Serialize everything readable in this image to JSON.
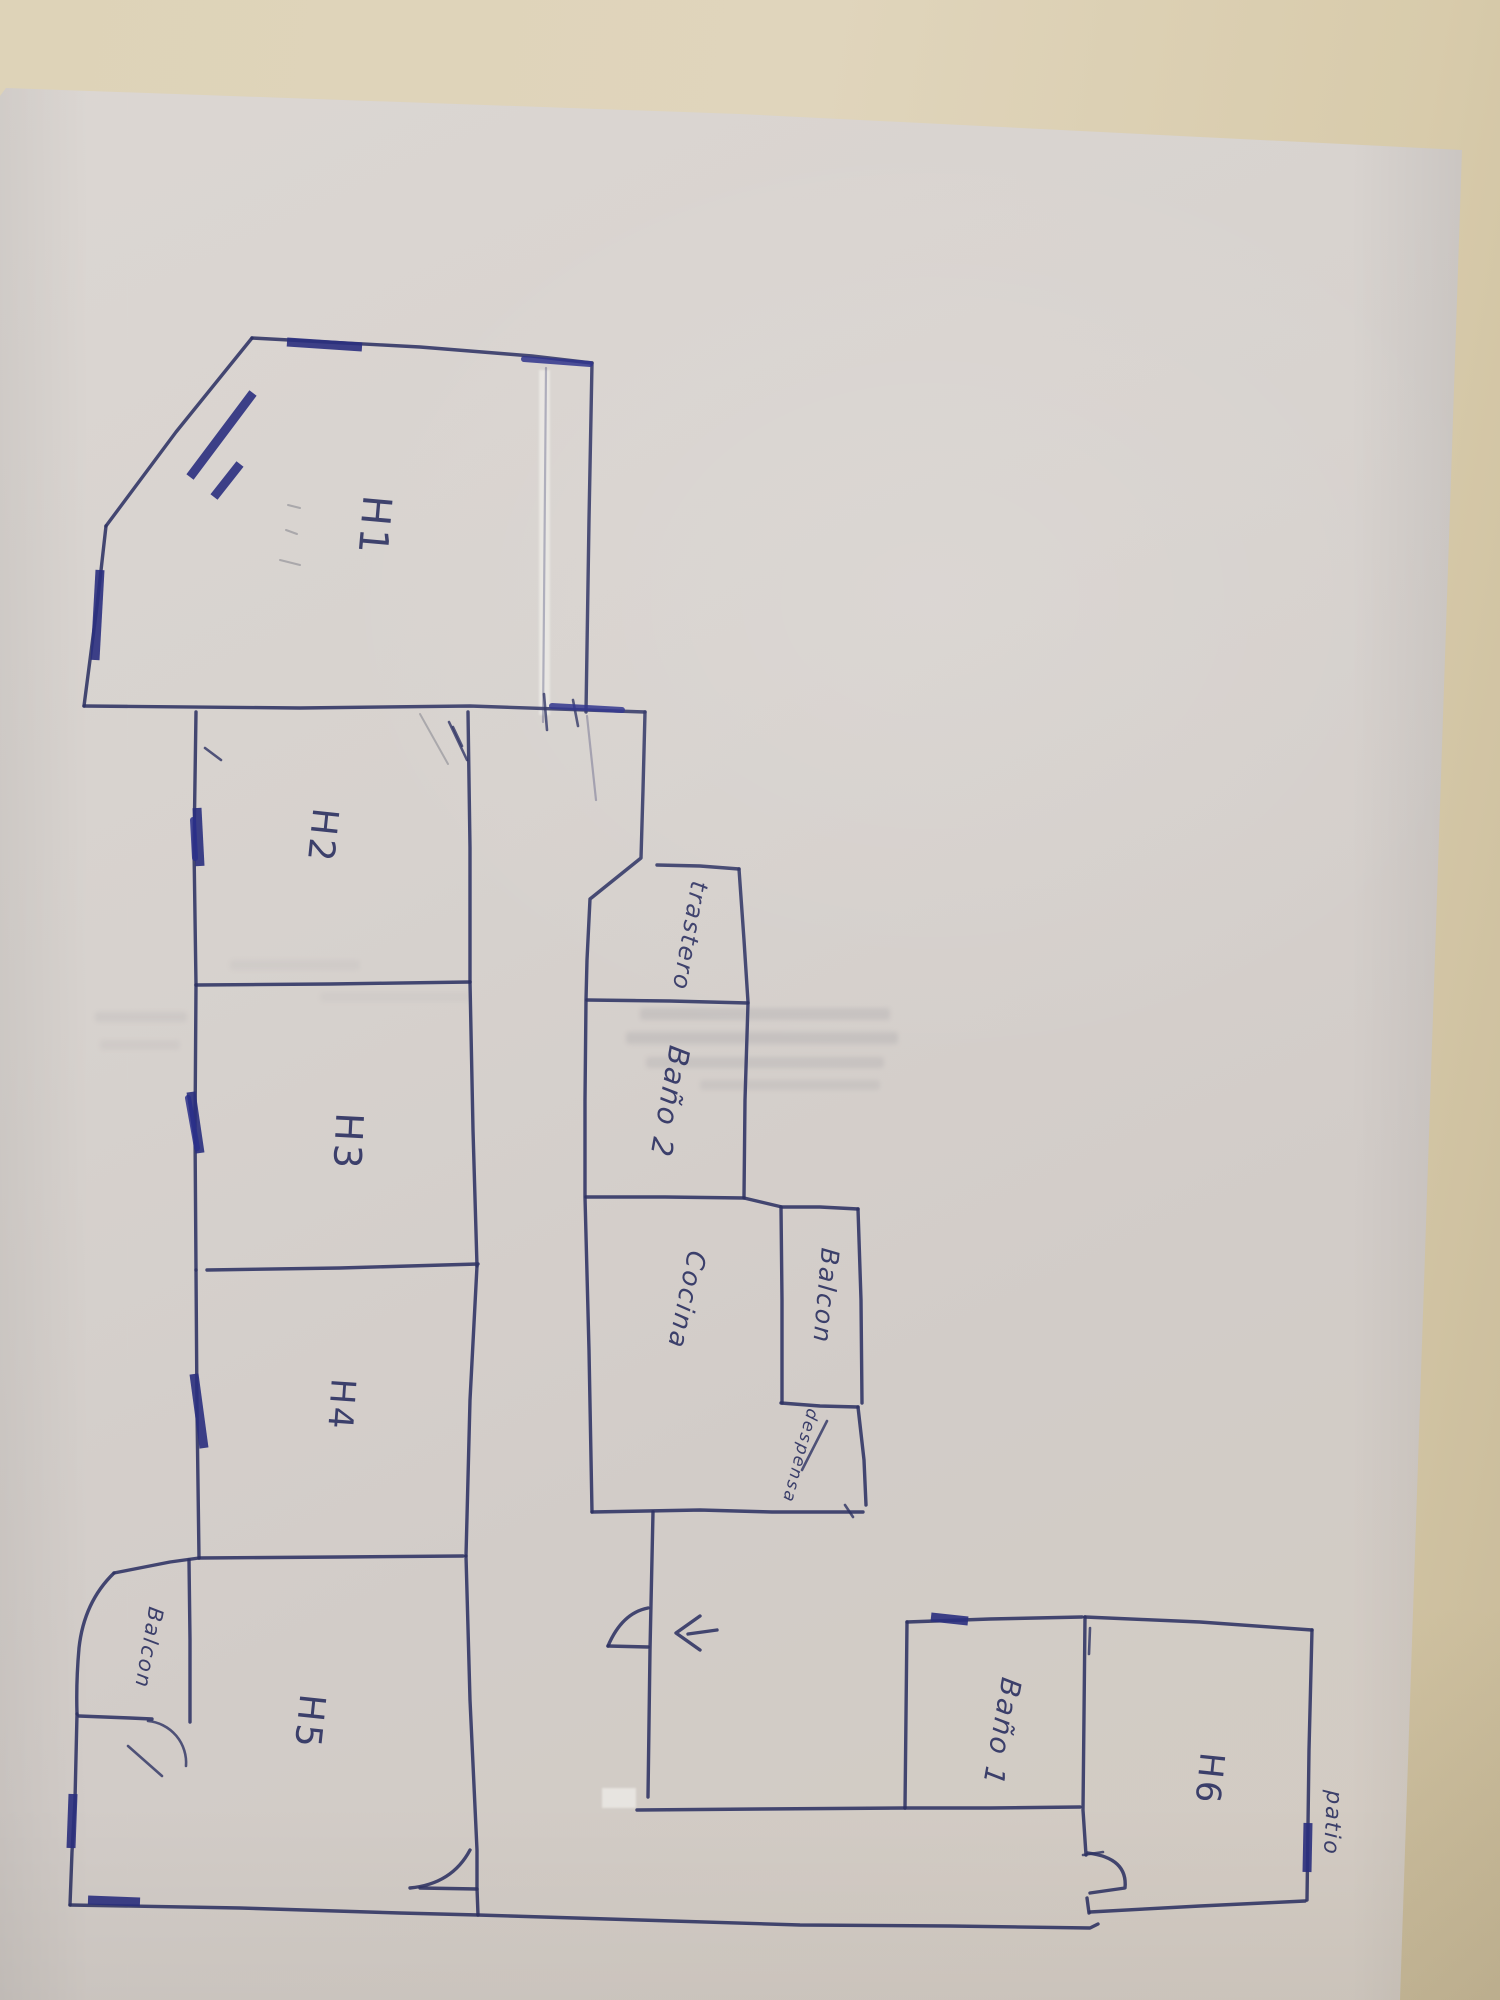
{
  "scene": {
    "description": "Hand-drawn apartment floor plan in blue ballpoint pen on a white sheet, photographed sideways on a beige table; all room labels are written rotated 90 degrees"
  },
  "floor_plan": {
    "rooms": [
      {
        "id": "h1",
        "label": "H1"
      },
      {
        "id": "h2",
        "label": "H2"
      },
      {
        "id": "h3",
        "label": "H3"
      },
      {
        "id": "h4",
        "label": "H4"
      },
      {
        "id": "h5",
        "label": "H5"
      },
      {
        "id": "balcon-left",
        "label": "Balcon"
      },
      {
        "id": "trastero",
        "label": "trastero"
      },
      {
        "id": "bano-2",
        "label": "Baño 2"
      },
      {
        "id": "cocina",
        "label": "Cocina"
      },
      {
        "id": "balcon-mid",
        "label": "Balcon"
      },
      {
        "id": "despensa",
        "label": "despensa"
      },
      {
        "id": "bano-1",
        "label": "Baño 1"
      },
      {
        "id": "h6",
        "label": "H6"
      },
      {
        "id": "patio",
        "label": "patio"
      }
    ],
    "entrance_arrow": {
      "symbol": "←",
      "meaning": "arrow drawn beside hallway door"
    }
  },
  "colors": {
    "ink": "#2d3263",
    "ink_heavy": "#2a2f7e",
    "paper": "#d7d2ce",
    "table": "#ddd1b4"
  }
}
